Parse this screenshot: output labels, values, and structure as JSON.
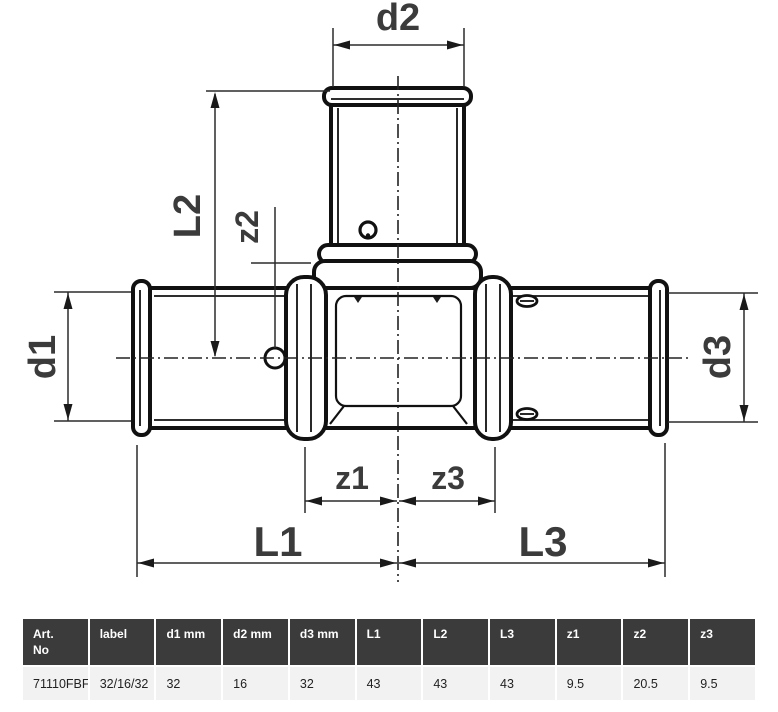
{
  "diagram": {
    "title": "press-tee-fitting-technical-drawing",
    "labels": {
      "d1": "d1",
      "d2": "d2",
      "d3": "d3",
      "L1": "L1",
      "L2": "L2",
      "L3": "L3",
      "z1": "z1",
      "z2": "z2",
      "z3": "z3"
    },
    "colors": {
      "outline": "#111111",
      "dimension_lines": "#2b2b2b",
      "labels": "#3b3b3b"
    }
  },
  "table": {
    "columns": [
      {
        "label": "Art.\nNo"
      },
      {
        "label": "label"
      },
      {
        "label": "d1 mm"
      },
      {
        "label": "d2 mm"
      },
      {
        "label": "d3 mm"
      },
      {
        "label": "L1"
      },
      {
        "label": "L2"
      },
      {
        "label": "L3"
      },
      {
        "label": "z1"
      },
      {
        "label": "z2"
      },
      {
        "label": "z3"
      }
    ],
    "rows": [
      {
        "art_no": "71110FBF",
        "label": "32/16/32",
        "d1_mm": "32",
        "d2_mm": "16",
        "d3_mm": "32",
        "L1": "43",
        "L2": "43",
        "L3": "43",
        "z1": "9.5",
        "z2": "20.5",
        "z3": "9.5"
      }
    ],
    "colors": {
      "header_bg": "#3b3b3b",
      "header_text": "#ffffff",
      "row_bg": "#f2f2f2",
      "row_text": "#222222"
    }
  }
}
